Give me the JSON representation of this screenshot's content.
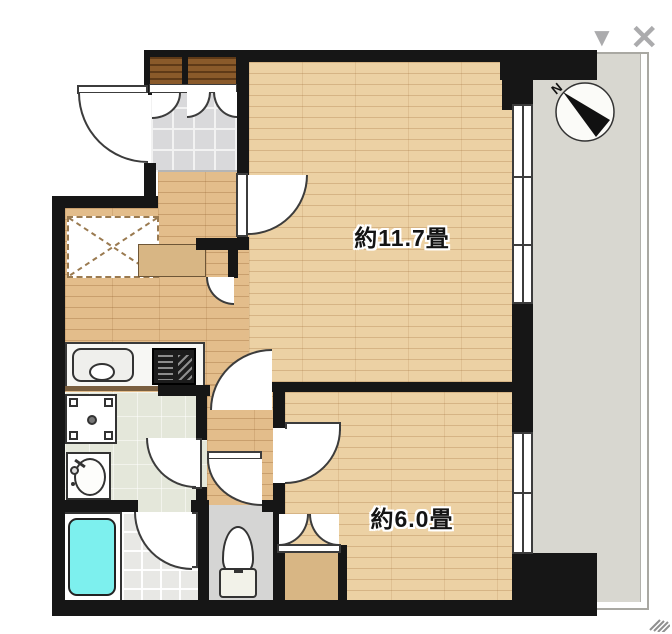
{
  "plan": {
    "rooms": [
      {
        "name": "約11.7畳"
      },
      {
        "name": "約6.0畳"
      }
    ],
    "compass": {
      "north_label": "N"
    },
    "controls": {
      "collapse_glyph": "▼",
      "close_glyph": "✕"
    },
    "colors": {
      "wall": "#161616",
      "wood_light": "#ecd1a4",
      "wood_dark": "#e3bd8b",
      "genkan_tile": "#d9d9db",
      "washroom_floor": "#e4e7da",
      "bath_tile": "#e8e8e5",
      "bathtub": "#7df0ee",
      "balcony": "#d8d7d0",
      "cabinet_brown": "#8a5a2a",
      "control_gray": "#ababad"
    },
    "fixtures": [
      "entrance-door",
      "shoe-cabinet",
      "refrigerator-space",
      "kitchen-sink",
      "gas-stove",
      "washing-machine-pan",
      "wash-basin",
      "bathtub",
      "toilet",
      "closet",
      "sliding-window",
      "balcony",
      "compass"
    ]
  }
}
